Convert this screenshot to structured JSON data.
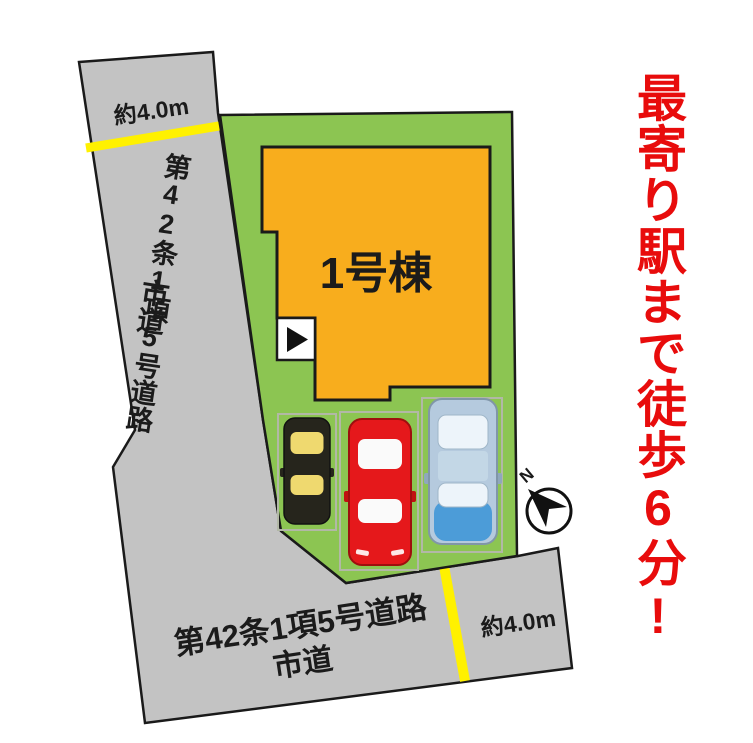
{
  "labels": {
    "building": "1号棟",
    "road_left": {
      "name": "第42条1項5号道路",
      "type": "市道",
      "width": "約4.0m"
    },
    "road_bottom": {
      "name": "第42条1項5号道路",
      "type": "市道",
      "width": "約4.0m"
    },
    "compass_north": "N",
    "tagline": "最寄り駅まで徒歩6分!"
  },
  "icons": {
    "entrance_arrow": "right-triangle",
    "compass": "north-arrow"
  },
  "colors": {
    "road_gray": "#C3C3C3",
    "plot_green": "#8CC552",
    "building_orange": "#F8AD1D",
    "lane_yellow": "#FFF100",
    "tagline_red": "#E80C0C",
    "text_black": "#1B1B1B",
    "stall_line": "#B2B8A6",
    "car_black_body": "#26251C",
    "car_black_window": "#EFD96F",
    "car_red_body": "#E5181B",
    "car_red_window": "#FAFAFA",
    "car_blue_body": "#B5CADE",
    "car_blue_window": "#EDF4FA",
    "car_blue_hood": "#4C9CD8"
  }
}
